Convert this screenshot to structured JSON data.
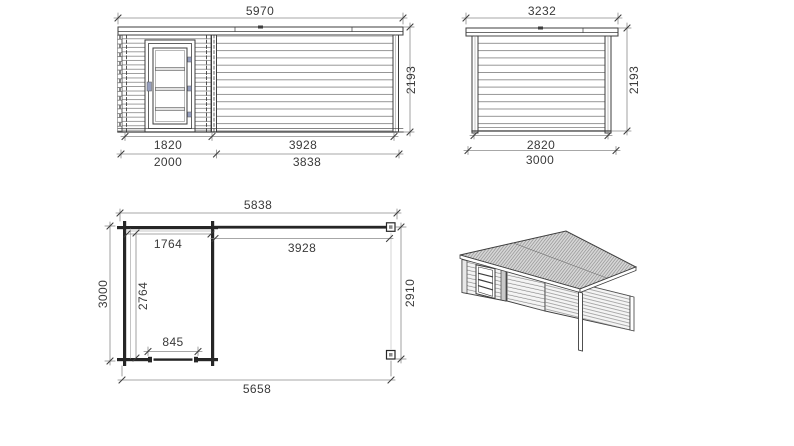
{
  "title": "Garden log cabin with side canopy - dimensioned technical drawing",
  "colors": {
    "line": "#3d3d3d",
    "wall": "#262626",
    "dim_line": "#8a8a8a",
    "text": "#3a3a3a",
    "hatch": "#8d8d8d",
    "hinge_accent": "#97a0c0"
  },
  "views": {
    "front_elevation": {
      "dims": {
        "overall_width": "5970",
        "height": "2193",
        "door_section_width": "1820",
        "open_section_width": "3928",
        "cabin_width": "2000",
        "canopy_width": "3838"
      }
    },
    "side_elevation": {
      "dims": {
        "overall_depth": "3232",
        "height": "2193",
        "wall_depth": "2820",
        "base_depth": "3000"
      }
    },
    "floor_plan": {
      "dims": {
        "overall_width": "5838",
        "room_inner_width": "1764",
        "canopy_width": "3928",
        "overall_depth": "3000",
        "room_inner_depth": "2764",
        "canopy_depth": "2910",
        "door_opening": "845",
        "base_width": "5658"
      }
    },
    "iso_view": {}
  }
}
